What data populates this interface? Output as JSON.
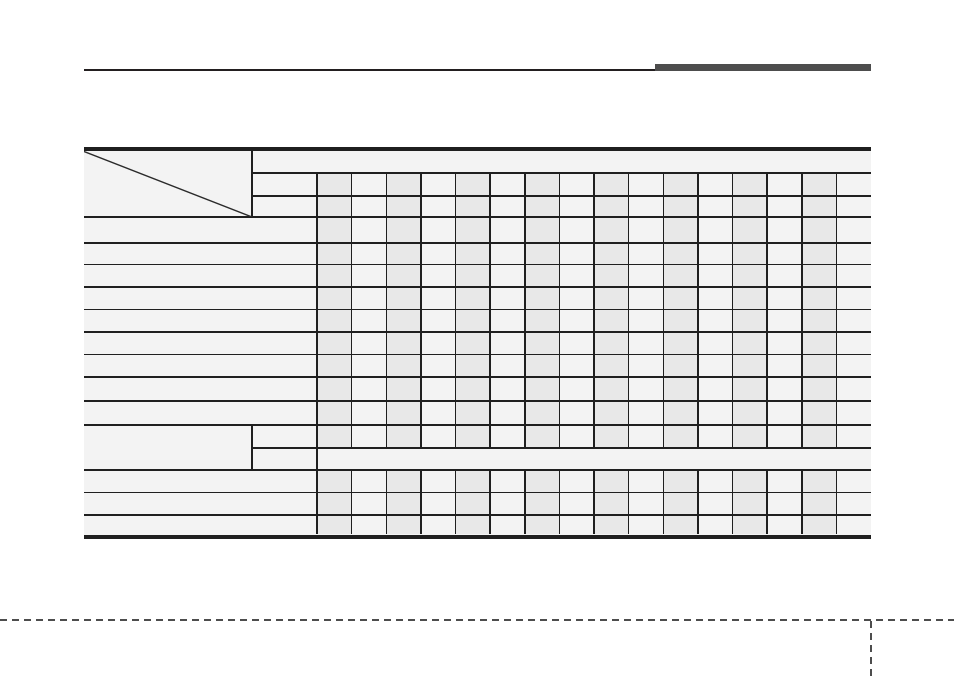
{
  "page": {
    "width": 954,
    "height": 685,
    "background": "#ffffff"
  },
  "header_rule": {
    "thin_line": {
      "x": 84,
      "y": 69,
      "width": 571,
      "height": 1.5,
      "color": "#231f20"
    },
    "accent_bar": {
      "x": 655,
      "y": 63.5,
      "width": 216,
      "height": 7.5,
      "color": "#4d4d4d"
    }
  },
  "table": {
    "x": 84,
    "right": 871,
    "top": 146.5,
    "bottom": 539,
    "background": "#f3f3f3",
    "shade_color": "#e8e8e8",
    "line_color": "#1f1f1f",
    "diagonal_color": "#2a2a2a",
    "border_thickness": 4,
    "line_thickness": 1.5,
    "diagonal_cell": {
      "x1": 84,
      "y1": 150.5,
      "x2": 252,
      "y2": 217
    },
    "header_col_right": 252,
    "label_col_right": 317,
    "small_col_count": 16,
    "small_col_width": 34.625,
    "shaded_col_indexes": [
      0,
      2,
      4,
      6,
      8,
      10,
      12,
      14
    ],
    "stripe_top": 173,
    "stripe_bottom": 534,
    "h_lines_full": [
      217,
      243,
      264.5,
      287,
      309.5,
      332,
      354.5,
      377,
      401,
      425,
      470,
      492.5,
      515
    ],
    "h_lines_from_header_col": [
      173,
      196,
      448
    ],
    "v_line_header_col_spans": [
      [
        150.5,
        217
      ],
      [
        425,
        470
      ]
    ],
    "v_line_label_col_span": [
      173,
      534
    ],
    "v_line_segment_a": [
      173,
      448
    ],
    "v_line_segment_b": [
      470,
      534
    ],
    "merged_band": {
      "x1": 317,
      "y1": 448,
      "x2": 871,
      "y2": 470
    },
    "empty_cells": true,
    "visible_text": ""
  },
  "footer": {
    "dash_color": "#4d4d4d",
    "dash_on": 7,
    "dash_off": 5,
    "thickness": 2,
    "horizontal_line": {
      "x": 0,
      "y": 619,
      "width": 954
    },
    "vertical_line": {
      "x": 870,
      "y": 621,
      "height": 58
    }
  }
}
